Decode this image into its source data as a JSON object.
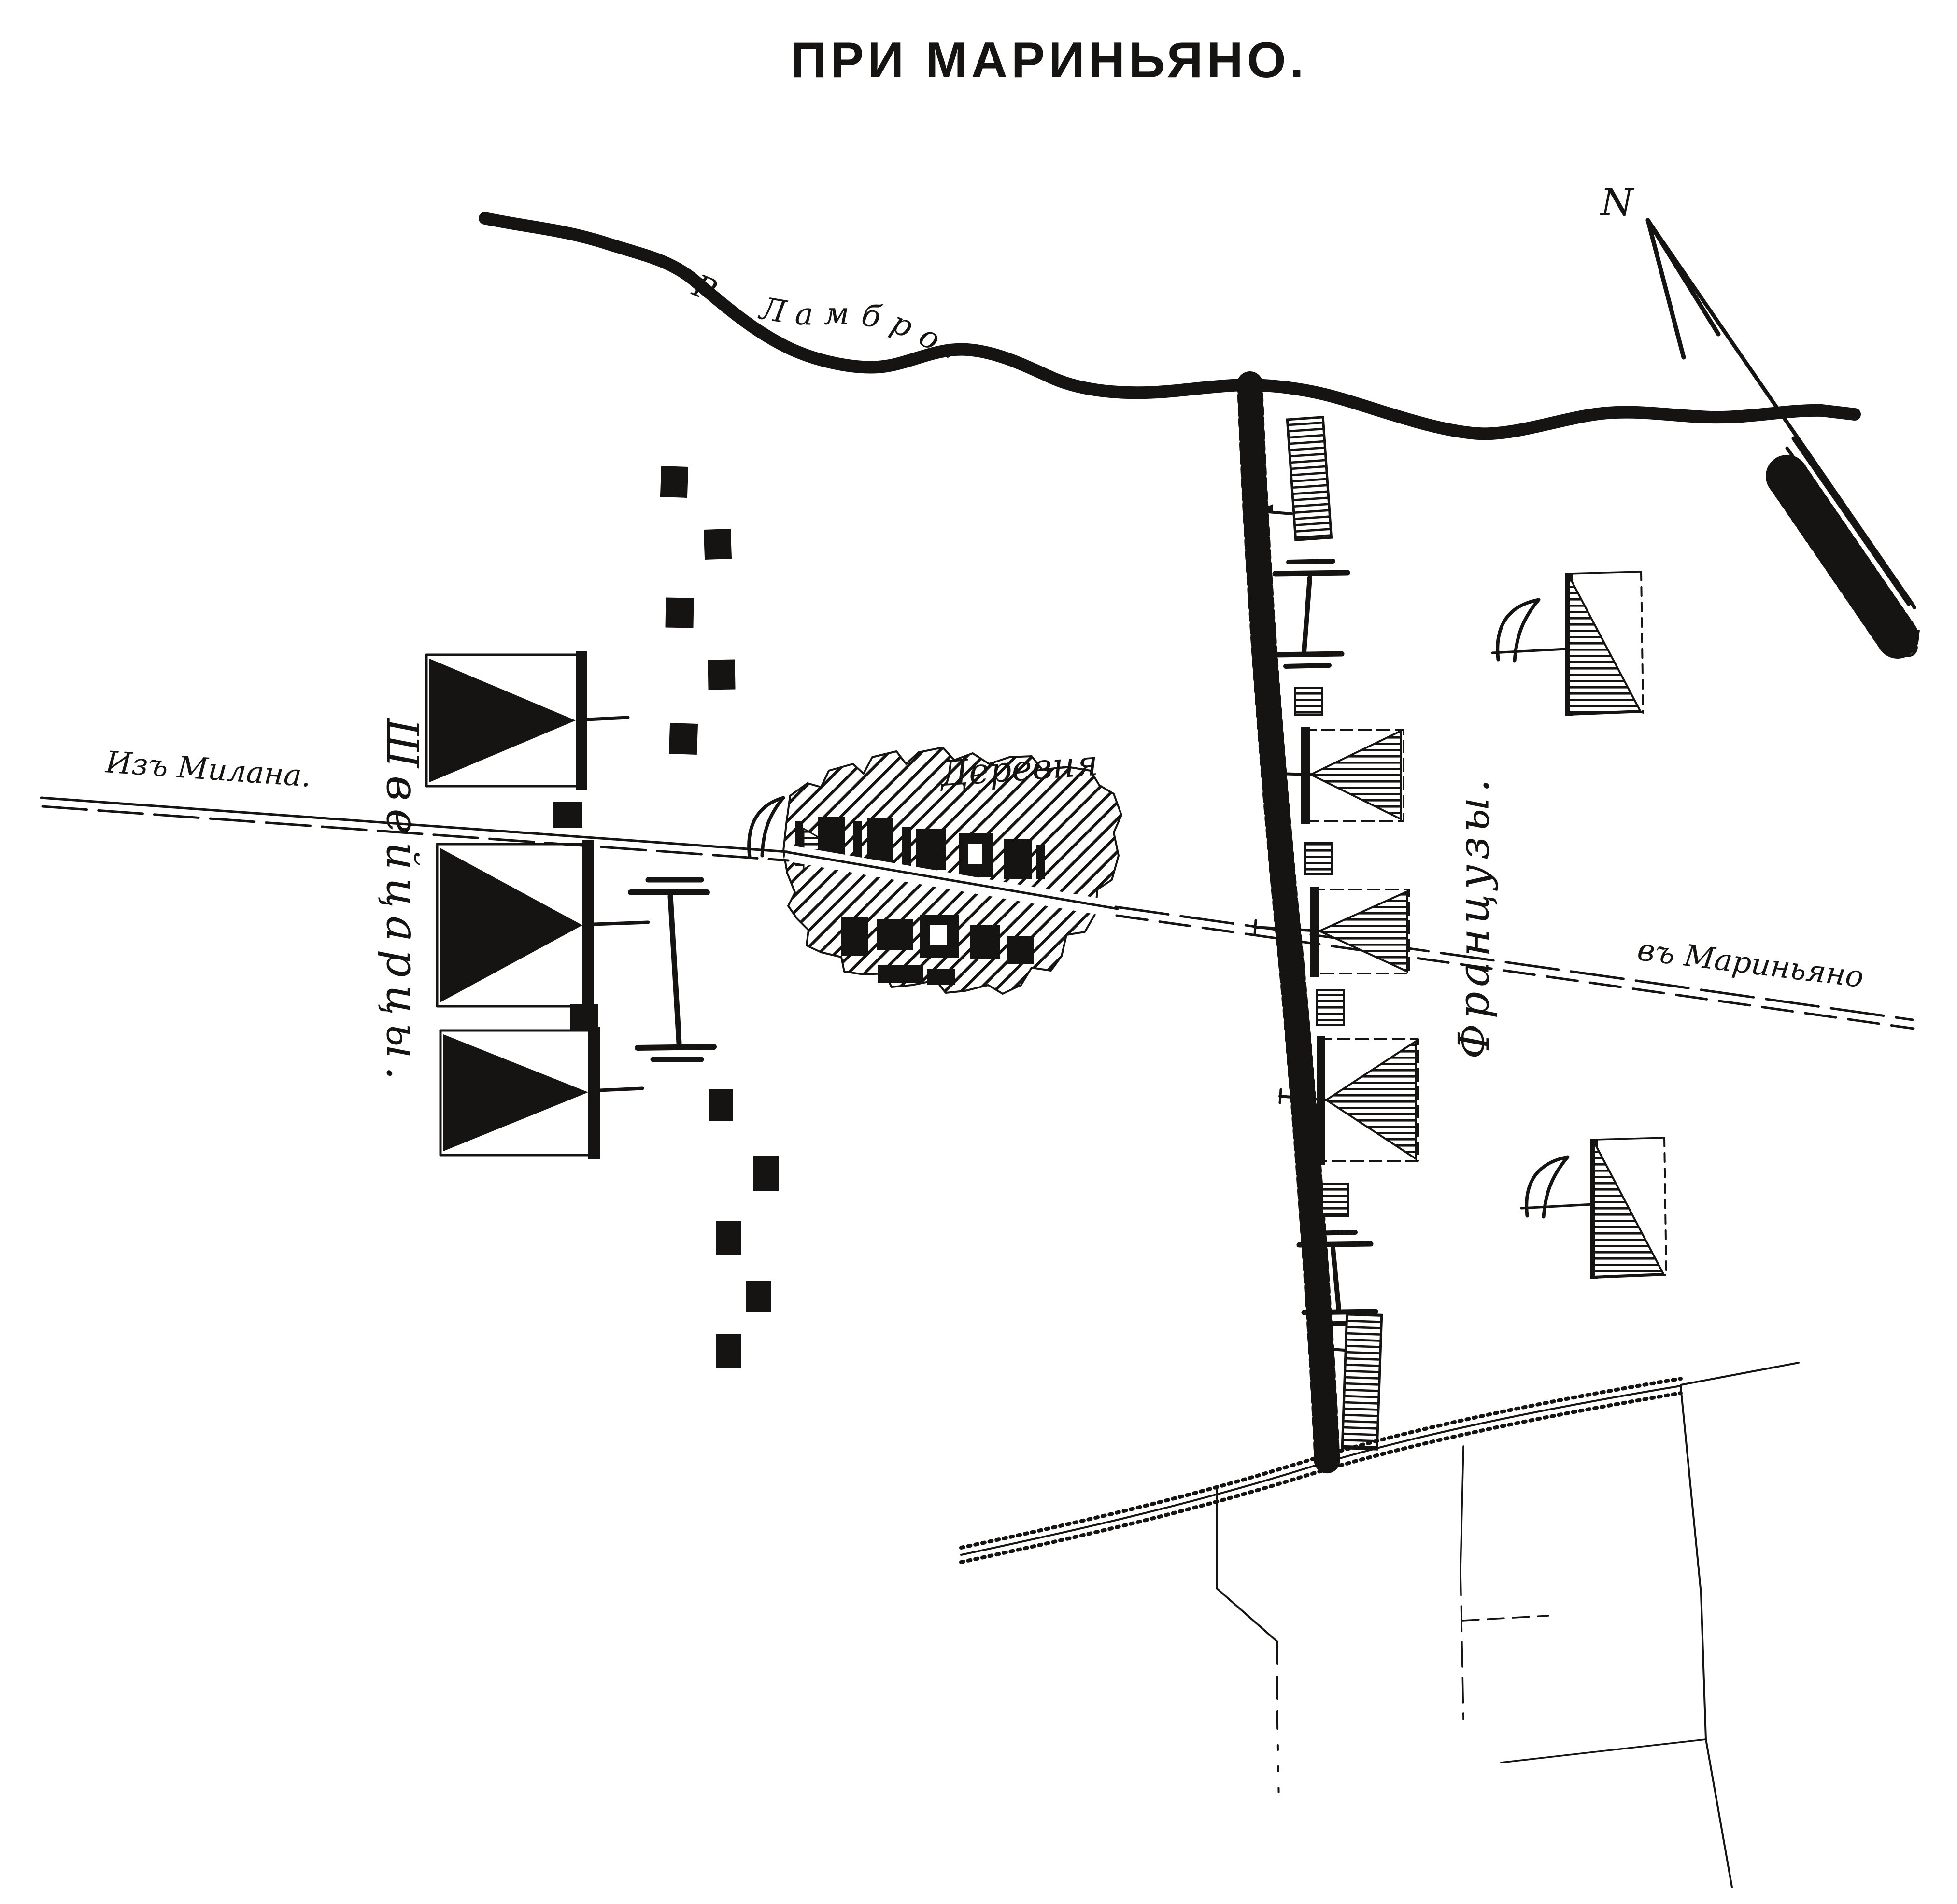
{
  "title": "ПРИ МАРИНЬЯНО.",
  "compass": {
    "north": "N",
    "south": "S"
  },
  "labels": {
    "river": "Р. Ламбро.",
    "road_from_milan": "Изъ Милана.",
    "road_to_marignano": "въ Мариньяно",
    "village": "Деревня",
    "swiss_army": "Швейцарцы.",
    "french_army": "Французы."
  },
  "colors": {
    "ink": "#161412",
    "paper": "#ffffff"
  },
  "symbols": {
    "swiss_infantry_squares": 3,
    "swiss_picket_posts": 12,
    "swiss_artillery_batteries": 1,
    "french_infantry_units": 4,
    "french_column_units": 1,
    "french_detachments": 4,
    "french_artillery_batteries": 2,
    "cavalry_vedette_crescents": 3
  }
}
